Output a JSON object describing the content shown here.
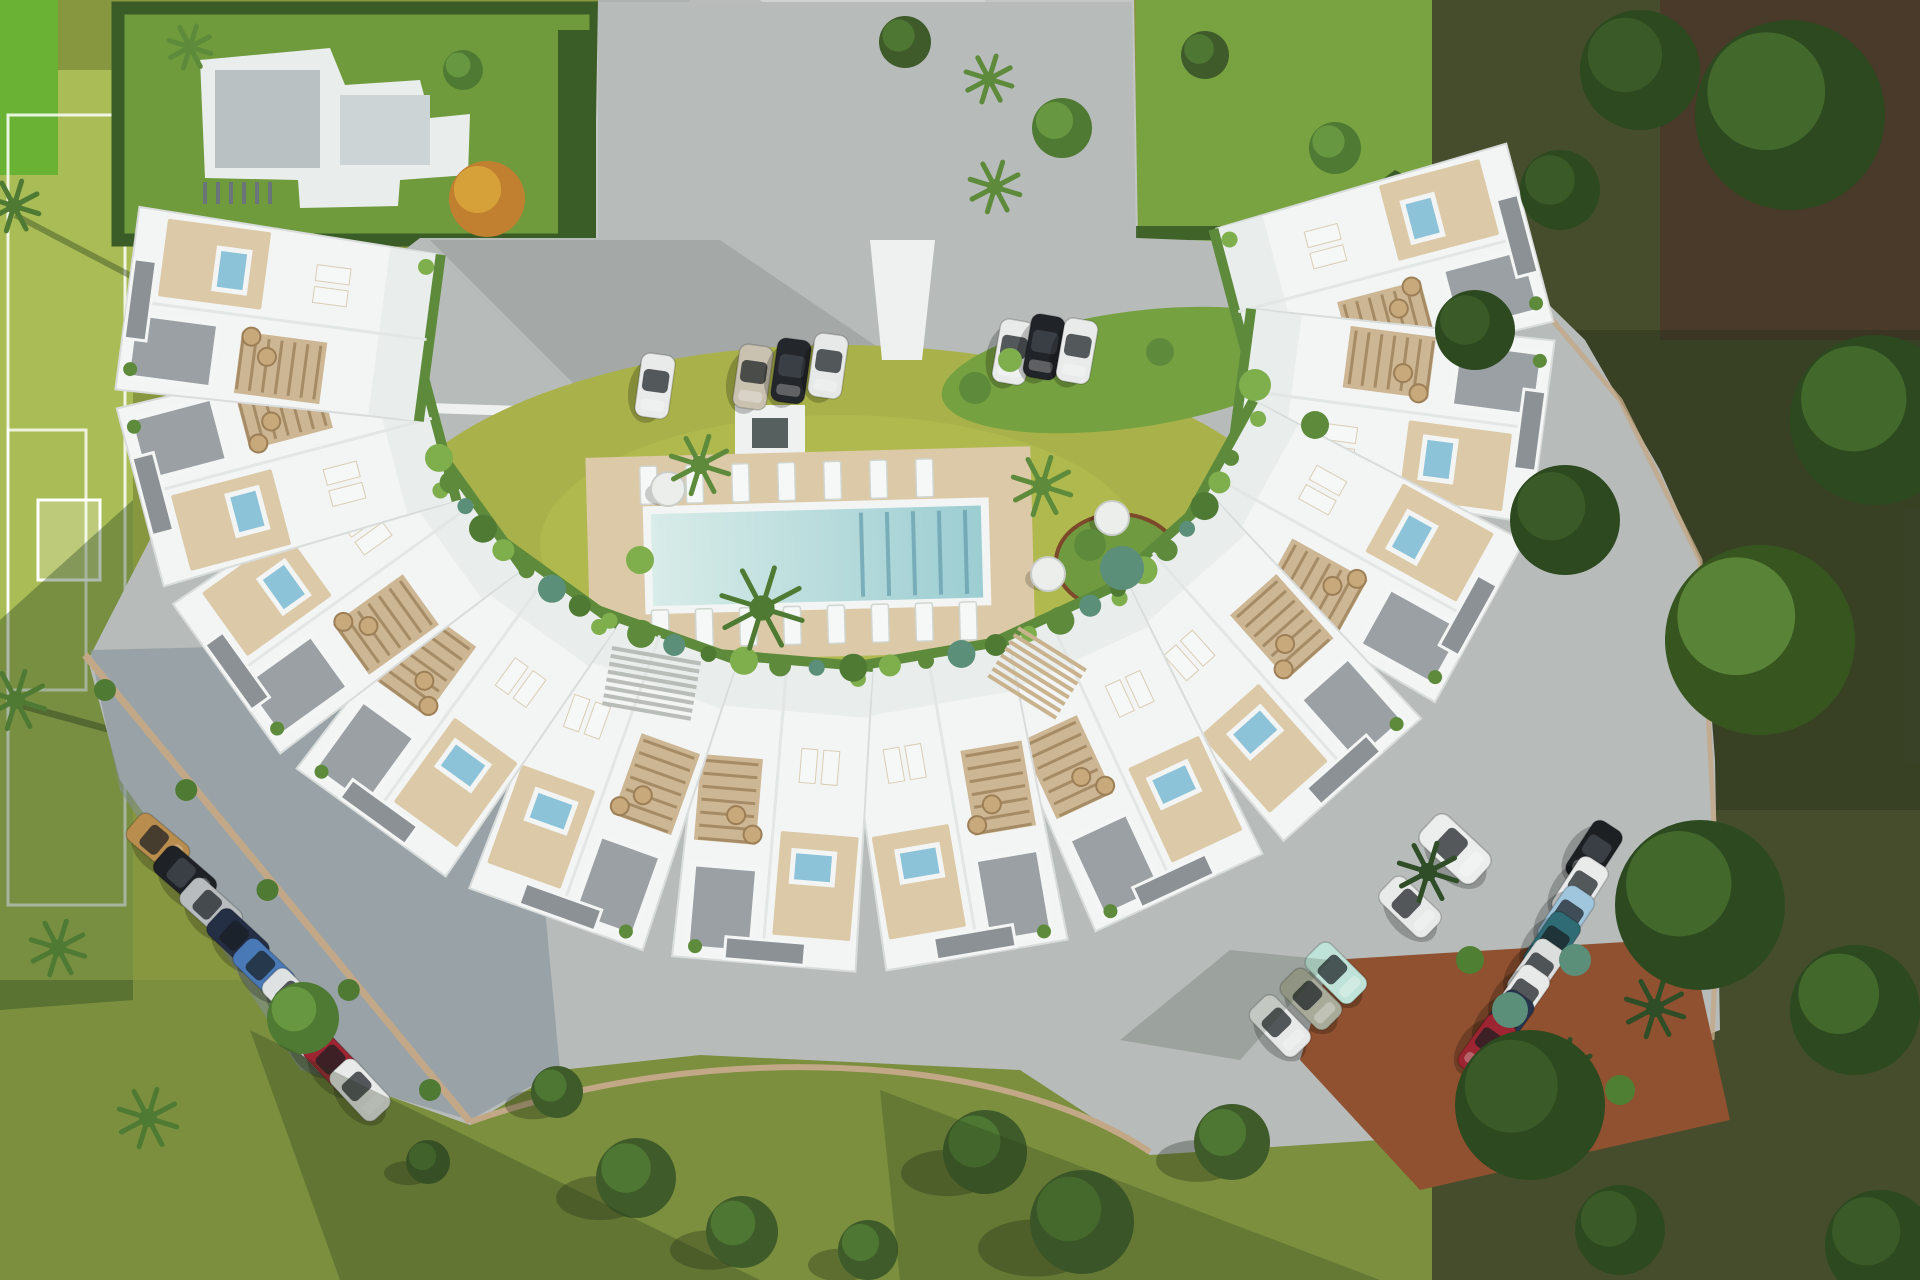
{
  "scene": {
    "description": "aerial-render-of-crescent-residential-complex-with-pool",
    "width": 1920,
    "height": 1280
  },
  "palette": {
    "bgLawn": "#87973f",
    "bottomLawn": "#7b8f3e",
    "fieldGreen": "#a9bc55",
    "brightCorner": "#69b234",
    "plotLawn": "#6f9b3c",
    "hedge": "#3a5c27",
    "topLawn": "#79a341",
    "driveGray": "#c3c6c4",
    "apron": "#d0d2cf",
    "forestBase": "#454d2c",
    "forestDark": "#493a2a",
    "pavement": "#b7bbba",
    "pavementShade": "#9aa3a8",
    "curb": "#c3a887",
    "wallWhite": "#eef1f0",
    "courtyard": "#a9b24a",
    "courtyardHi": "#b8c151",
    "deckTan": "#dcc9a7",
    "poolRim": "#f2f5f4",
    "poolLight": "#d8ece8",
    "poolDeep": "#9ccdd2",
    "laneLine": "#5e98a8",
    "unitWhite": "#f3f5f4",
    "unitEdge": "#d8dcdb",
    "innerTerrace": "#e9edec",
    "gravel": "#9aa0a3",
    "gravelDark": "#8b9194",
    "pergola": "#cdb694",
    "pergolaLine": "#a58c66",
    "jacuzzi": "#8cc3d8",
    "lounger": "#f6f8f7",
    "wicker": "#c7a97b",
    "plantGreen": "#5d8b3b",
    "plantBright": "#7fae4d",
    "bushTeal": "#5b8f7a",
    "terracotta": "#8f5130",
    "villaWhite": "#e9edec",
    "villaRoof": "#b9c1c3",
    "treeDark": "#3f5b2a",
    "treeMid": "#4f7a33",
    "treeHi": "#6a9a42",
    "forestTree": "#2c491f",
    "forestTreeHi": "#466b2e",
    "tableWhite": "#eceeec",
    "stairGray": "#b9bdb9",
    "stairTan": "#c9b28e",
    "shadow": "rgba(25,35,20,0.30)"
  },
  "crescent": {
    "cx": 835,
    "cy": 365,
    "rx": 560,
    "ry": 450,
    "unit_w": 175,
    "unit_l": 310,
    "angles": [
      -12,
      6,
      24,
      42,
      60,
      78,
      96,
      114,
      132,
      150,
      168,
      186
    ],
    "inner_planting": {
      "cx": 835,
      "cy": 378,
      "rx": 412,
      "ry": 290,
      "start": 16,
      "end": 164,
      "count": 30
    }
  },
  "pool_area": {
    "deck": {
      "x": 588,
      "y": 452,
      "w": 445,
      "h": 205,
      "rot": -1.5
    },
    "pool": {
      "x": 652,
      "y": 510,
      "w": 330,
      "h": 92
    },
    "lanes": {
      "x0": 862,
      "n": 5,
      "dx": 26
    },
    "loungers_top": {
      "x0": 642,
      "y": 462,
      "n": 7,
      "dx": 46,
      "w": 17,
      "h": 38
    },
    "loungers_bottom": {
      "x0": 650,
      "y": 606,
      "n": 8,
      "dx": 44,
      "w": 17,
      "h": 38
    },
    "tables": [
      [
        668,
        489
      ],
      [
        1112,
        518
      ],
      [
        1048,
        574
      ]
    ]
  },
  "stairs": [
    {
      "x": 612,
      "y": 648,
      "rot": 10,
      "n": 8,
      "len": 90,
      "step": 8,
      "color": "#b9bdb9"
    },
    {
      "x": 1018,
      "y": 628,
      "rot": 32,
      "n": 8,
      "len": 80,
      "step": 8,
      "color": "#c9b28e"
    }
  ],
  "cars": [
    {
      "x": 655,
      "y": 386,
      "rot": 8,
      "color": "#e9ebea"
    },
    {
      "x": 753,
      "y": 377,
      "rot": 8,
      "color": "#c9c2b0"
    },
    {
      "x": 791,
      "y": 371,
      "rot": 8,
      "color": "#23262a"
    },
    {
      "x": 828,
      "y": 366,
      "rot": 8,
      "color": "#e7e9e8"
    },
    {
      "x": 1013,
      "y": 352,
      "rot": 10,
      "color": "#e9ebea"
    },
    {
      "x": 1044,
      "y": 347,
      "rot": 10,
      "color": "#202327"
    },
    {
      "x": 1077,
      "y": 351,
      "rot": 10,
      "color": "#e9ebea"
    },
    {
      "x": 158,
      "y": 843,
      "rot": -50,
      "color": "#b98d4e"
    },
    {
      "x": 185,
      "y": 876,
      "rot": -49,
      "color": "#1e2125"
    },
    {
      "x": 211,
      "y": 908,
      "rot": -48,
      "color": "#b8bcbf"
    },
    {
      "x": 238,
      "y": 939,
      "rot": -47,
      "color": "#242e44"
    },
    {
      "x": 264,
      "y": 969,
      "rot": -46,
      "color": "#4a79b8"
    },
    {
      "x": 293,
      "y": 999,
      "rot": -45,
      "color": "#dfe2e2"
    },
    {
      "x": 314,
      "y": 1043,
      "rot": -44,
      "color": "#e6e8e8"
    },
    {
      "x": 334,
      "y": 1063,
      "rot": -44,
      "color": "#9c2531"
    },
    {
      "x": 360,
      "y": 1090,
      "rot": -43,
      "color": "#e8eae9"
    },
    {
      "x": 1455,
      "y": 849,
      "rot": -47,
      "color": "#eceeed",
      "scale": 1.15
    },
    {
      "x": 1410,
      "y": 907,
      "rot": -46,
      "color": "#e8eae9"
    },
    {
      "x": 1336,
      "y": 973,
      "rot": -45,
      "color": "#bfe3d8"
    },
    {
      "x": 1311,
      "y": 999,
      "rot": -45,
      "color": "#a8ab99"
    },
    {
      "x": 1280,
      "y": 1026,
      "rot": -44,
      "color": "#e7e9e8"
    },
    {
      "x": 1594,
      "y": 853,
      "rot": 33,
      "color": "#1d2023"
    },
    {
      "x": 1580,
      "y": 889,
      "rot": 33,
      "color": "#e9ebea"
    },
    {
      "x": 1566,
      "y": 918,
      "rot": 34,
      "color": "#9fc6dd"
    },
    {
      "x": 1552,
      "y": 944,
      "rot": 34,
      "color": "#2f6b74"
    },
    {
      "x": 1536,
      "y": 971,
      "rot": 35,
      "color": "#dcdedd"
    },
    {
      "x": 1521,
      "y": 997,
      "rot": 35,
      "color": "#e8eae9"
    },
    {
      "x": 1505,
      "y": 1022,
      "rot": 36,
      "color": "#28344e"
    },
    {
      "x": 1487,
      "y": 1046,
      "rot": 36,
      "color": "#9c2531"
    }
  ],
  "trees": [
    {
      "t": "palm",
      "x": 14,
      "y": 206,
      "r": 26,
      "c": "#4f7a33"
    },
    {
      "t": "palm",
      "x": 16,
      "y": 700,
      "r": 30,
      "c": "#4f7a33"
    },
    {
      "t": "palm",
      "x": 190,
      "y": 47,
      "r": 22,
      "c": "#5d8b3b"
    },
    {
      "t": "round",
      "x": 463,
      "y": 70,
      "r": 20,
      "c": "#4f7a33",
      "h": "#6a9a42"
    },
    {
      "t": "round",
      "x": 487,
      "y": 199,
      "r": 38,
      "c": "#c08030",
      "h": "#d9a43c"
    },
    {
      "t": "palm",
      "x": 989,
      "y": 79,
      "r": 24,
      "c": "#5d8b3b"
    },
    {
      "t": "palm",
      "x": 995,
      "y": 187,
      "r": 26,
      "c": "#5d8b3b"
    },
    {
      "t": "round",
      "x": 905,
      "y": 42,
      "r": 26,
      "c": "#3f5b2a",
      "h": "#4f7a33"
    },
    {
      "t": "round",
      "x": 1062,
      "y": 128,
      "r": 30,
      "c": "#4f7a33",
      "h": "#6a9a42"
    },
    {
      "t": "round",
      "x": 1205,
      "y": 55,
      "r": 24,
      "c": "#3f5b2a",
      "h": "#4f7a33"
    },
    {
      "t": "round",
      "x": 1335,
      "y": 148,
      "r": 26,
      "c": "#4f7a33",
      "h": "#6a9a42"
    },
    {
      "t": "bush",
      "x": 975,
      "y": 388,
      "r": 16,
      "c": "#5d8b3b"
    },
    {
      "t": "bush",
      "x": 1010,
      "y": 360,
      "r": 12,
      "c": "#7fae4d"
    },
    {
      "t": "bush",
      "x": 1160,
      "y": 352,
      "r": 14,
      "c": "#5d8b3b"
    },
    {
      "t": "bush",
      "x": 1255,
      "y": 385,
      "r": 16,
      "c": "#7fae4d"
    },
    {
      "t": "bush",
      "x": 1315,
      "y": 425,
      "r": 14,
      "c": "#5d8b3b"
    },
    {
      "t": "palm",
      "x": 700,
      "y": 465,
      "r": 30,
      "c": "#5d8b3b"
    },
    {
      "t": "palm",
      "x": 762,
      "y": 608,
      "r": 42,
      "c": "#4f7a33"
    },
    {
      "t": "palm",
      "x": 1042,
      "y": 486,
      "r": 30,
      "c": "#5d8b3b"
    },
    {
      "t": "bush",
      "x": 1122,
      "y": 568,
      "r": 22,
      "c": "#5b8f7a"
    },
    {
      "t": "bush",
      "x": 1090,
      "y": 545,
      "r": 16,
      "c": "#5d8b3b"
    },
    {
      "t": "bush",
      "x": 640,
      "y": 560,
      "r": 14,
      "c": "#7fae4d"
    },
    {
      "t": "round",
      "x": 303,
      "y": 1018,
      "r": 36,
      "c": "#4f7a33",
      "h": "#6a9a42"
    },
    {
      "t": "palm",
      "x": 58,
      "y": 948,
      "r": 28,
      "c": "#4f7a33"
    },
    {
      "t": "palm",
      "x": 148,
      "y": 1118,
      "r": 30,
      "c": "#4f7a33"
    },
    {
      "t": "round",
      "x": 636,
      "y": 1178,
      "r": 40,
      "c": "#3f5b2a",
      "h": "#4f7a33",
      "sh": 1
    },
    {
      "t": "round",
      "x": 742,
      "y": 1232,
      "r": 36,
      "c": "#3f5b2a",
      "h": "#4f7a33",
      "sh": 1
    },
    {
      "t": "round",
      "x": 985,
      "y": 1152,
      "r": 42,
      "c": "#3f5b2a",
      "h": "#4f7a33",
      "sh": 1
    },
    {
      "t": "round",
      "x": 1082,
      "y": 1222,
      "r": 52,
      "c": "#42602c",
      "h": "#527e36",
      "sh": 1
    },
    {
      "t": "round",
      "x": 1232,
      "y": 1142,
      "r": 38,
      "c": "#3f5b2a",
      "h": "#4f7a33",
      "sh": 1
    },
    {
      "t": "round",
      "x": 557,
      "y": 1092,
      "r": 26,
      "c": "#3f5b2a",
      "h": "#4f7a33",
      "sh": 1
    },
    {
      "t": "round",
      "x": 428,
      "y": 1162,
      "r": 22,
      "c": "#3f5b2a",
      "h": "#4f7a33",
      "sh": 1
    },
    {
      "t": "round",
      "x": 868,
      "y": 1250,
      "r": 30,
      "c": "#3f5b2a",
      "h": "#4f7a33",
      "sh": 1
    },
    {
      "t": "palm",
      "x": 1428,
      "y": 872,
      "r": 30,
      "c": "#2f4d26"
    },
    {
      "t": "palm",
      "x": 1560,
      "y": 1072,
      "r": 34,
      "c": "#2f4d26"
    },
    {
      "t": "palm",
      "x": 1655,
      "y": 1008,
      "r": 30,
      "c": "#2f4d26"
    },
    {
      "t": "bush",
      "x": 1510,
      "y": 1010,
      "r": 18,
      "c": "#5b8f7a"
    },
    {
      "t": "bush",
      "x": 1575,
      "y": 960,
      "r": 16,
      "c": "#5b8f7a"
    },
    {
      "t": "bush",
      "x": 1470,
      "y": 960,
      "r": 14,
      "c": "#4f7f33"
    },
    {
      "t": "bush",
      "x": 1620,
      "y": 1090,
      "r": 15,
      "c": "#4f7f33"
    },
    {
      "t": "round",
      "x": 1790,
      "y": 115,
      "r": 95,
      "c": "#2c491f",
      "h": "#466b2e"
    },
    {
      "t": "round",
      "x": 1640,
      "y": 70,
      "r": 60,
      "c": "#2c491f",
      "h": "#3c5c28"
    },
    {
      "t": "round",
      "x": 1560,
      "y": 190,
      "r": 40,
      "c": "#2c491f",
      "h": "#3c5c28"
    },
    {
      "t": "round",
      "x": 1875,
      "y": 420,
      "r": 85,
      "c": "#2c491f",
      "h": "#466b2e"
    },
    {
      "t": "round",
      "x": 1760,
      "y": 640,
      "r": 95,
      "c": "#36551f",
      "h": "#5d8a3a"
    },
    {
      "t": "round",
      "x": 1565,
      "y": 520,
      "r": 55,
      "c": "#2c491f",
      "h": "#3c5c28"
    },
    {
      "t": "round",
      "x": 1700,
      "y": 905,
      "r": 85,
      "c": "#2c491f",
      "h": "#466b2e"
    },
    {
      "t": "round",
      "x": 1530,
      "y": 1105,
      "r": 75,
      "c": "#2c491f",
      "h": "#3c5c28"
    },
    {
      "t": "round",
      "x": 1855,
      "y": 1010,
      "r": 65,
      "c": "#2c491f",
      "h": "#466b2e"
    },
    {
      "t": "round",
      "x": 1880,
      "y": 1245,
      "r": 55,
      "c": "#2c491f",
      "h": "#3c5c28"
    },
    {
      "t": "round",
      "x": 1620,
      "y": 1230,
      "r": 45,
      "c": "#2c491f",
      "h": "#3c5c28"
    },
    {
      "t": "round",
      "x": 1475,
      "y": 330,
      "r": 40,
      "c": "#2c491f",
      "h": "#3c5c28"
    }
  ],
  "hedge_bushes": {
    "x1": 105,
    "y1": 690,
    "x2": 430,
    "y2": 1090,
    "n": 5,
    "r": 11
  }
}
